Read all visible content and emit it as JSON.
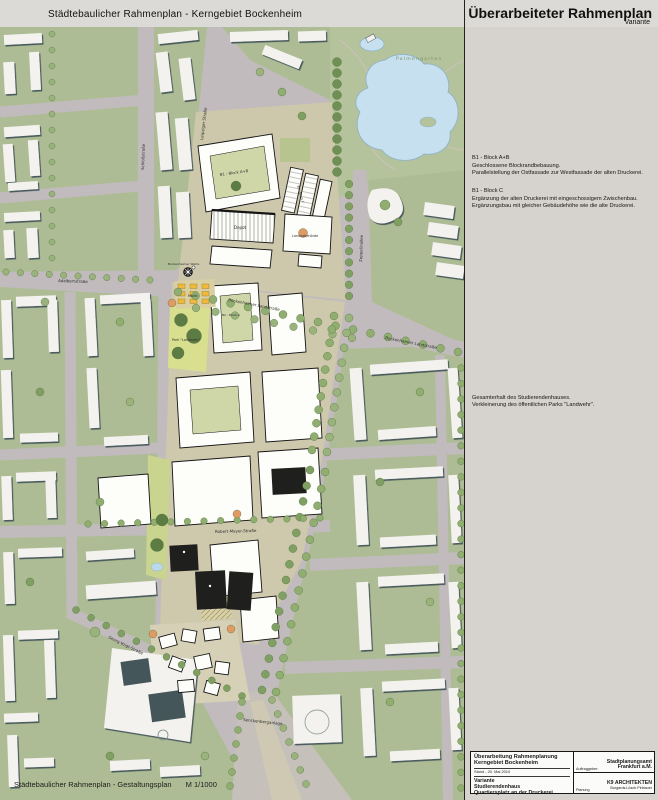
{
  "header": {
    "left_title": "Städtebaulicher Rahmenplan - Kerngebiet Bockenheim",
    "right_title": "Überarbeiteter Rahmenplan",
    "right_subtitle": "Variante"
  },
  "footer": {
    "label": "Städtebaulicher Rahmenplan - Gestaltungsplan",
    "scale": "M 1/1000"
  },
  "annotations": [
    {
      "title": "B1 - Block A+B",
      "lines": [
        "Geschlossene Blockrandbebauung.",
        "Parallelstellung der Ostfassade zur Westfassade der alten Druckerei."
      ]
    },
    {
      "title": "B1 - Block C",
      "lines": [
        "Ergänzung der alten Druckerei mit eingeschossigem Zwischenbau.",
        "Ergänzungsbau mit gleicher Gebäudehöhe wie die alte Druckerei."
      ]
    },
    {
      "title": "",
      "lines": [
        "Gesamterhalt des Studierendenhauses.",
        "Verkleinerung des öffentlichen Parks \"Landwehr\"."
      ]
    }
  ],
  "title_block": {
    "project_line1": "Überarbeitung Rahmenplanung",
    "project_line2": "Kerngebiet Bockenheim",
    "stand": "Stand - 20. Mai 2010",
    "variant_line1": "Variante",
    "variant_line2": "Studierendenhaus",
    "variant_line3": "Quartiersplatz an der Druckerei",
    "client_label": "Auftraggeber:",
    "client_line1": "Stadtplanungsamt",
    "client_line2": "Frankfurt a.M.",
    "planner_label": "Planung",
    "planner_line1": "K9 ARCHITEKTEN",
    "planner_line2": "Borgards.Lösch.Piribauer"
  },
  "map": {
    "labels": {
      "palmengarten": "Palmengarten",
      "zeppelinallee": "Zeppelinallee",
      "leipziger_strasse": "Leipziger Straße",
      "schlossstrasse": "Schloßstraße",
      "adalbertstrasse": "Adalbertstraße",
      "bockenheimer_landstrasse": "Bockenheimer Landstraße",
      "robert_mayer_strasse": "Robert-Mayer-Straße",
      "georg_voigt_strasse": "Georg-Voigt-Straße",
      "senckenberganlage": "Senckenberganlage",
      "bockenheimer_warte": "Bockenheimer Warte",
      "markt": "Markt",
      "park_landwehr": "Park \"Landwehr\"",
      "depot": "Depot",
      "landesbehoerde": "Landesbehörde",
      "block_b1ab": "B1 - Block A+B",
      "block_b1c": "B1 - Block C",
      "block_b2a": "B2 - Block A"
    },
    "colors": {
      "street": "#c1bbbd",
      "block_green": "#adbc94",
      "park_green": "#b4c39b",
      "pond_blue": "#c7e0f0",
      "building_white": "#f3f2ef",
      "building_shadow": "#44565a",
      "plan_white": "#fdfdfa",
      "black_building": "#1f1f1d",
      "park_yellow": "#d8e08f",
      "plaza_beige": "#d9d0a6",
      "market_yellow": "#efb93c",
      "tree_green": "#8fae70",
      "accent_orange": "#e09a64"
    }
  }
}
